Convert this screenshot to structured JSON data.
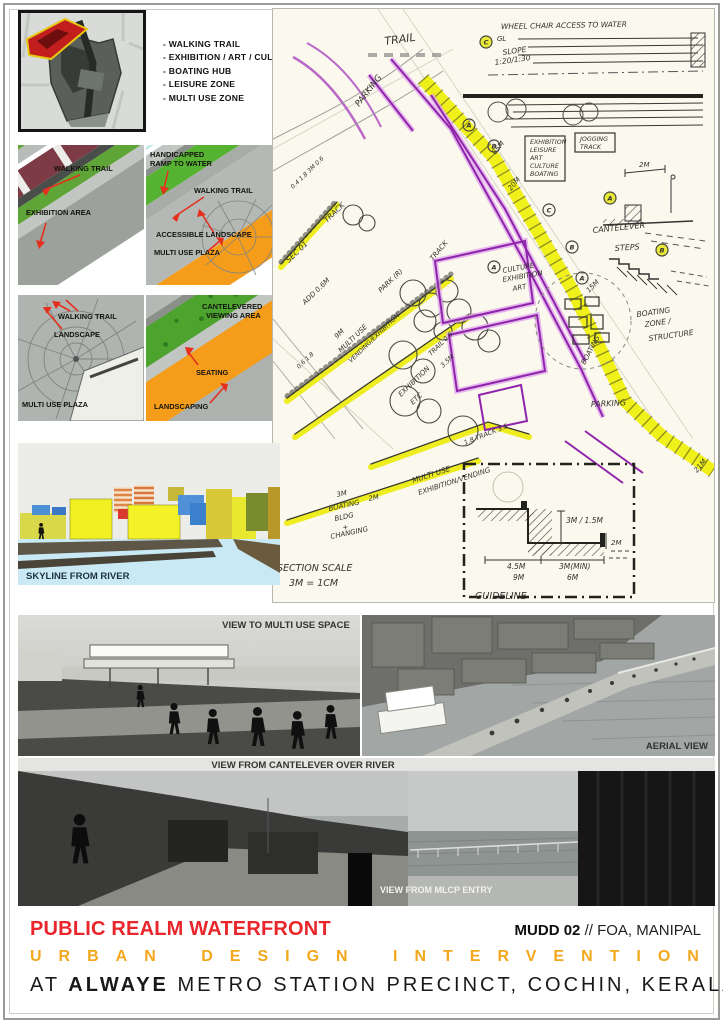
{
  "legend": {
    "items": [
      "- WALKING TRAIL",
      "- EXHIBITION / ART / CULTURE ZONE",
      "- BOATING HUB",
      "- LEISURE ZONE",
      "- MULTI USE ZONE"
    ]
  },
  "colors": {
    "accent_red": "#E8262C",
    "accent_amber": "#F2A71C",
    "highlight_yellow": "#EFEF08",
    "sketch_purple": "#8E24AA"
  },
  "sketch": {
    "labels": [
      {
        "id": "trail",
        "t": "TRAIL",
        "x": 112,
        "y": 36,
        "r": -8,
        "s": 11
      },
      {
        "id": "wheelchair-access",
        "t": "WHEEL CHAIR ACCESS TO WATER",
        "x": 228,
        "y": 20,
        "r": -1,
        "s": 7.5
      },
      {
        "id": "gl",
        "t": "GL",
        "x": 224,
        "y": 32,
        "s": 7
      },
      {
        "id": "slope",
        "t": "SLOPE",
        "x": 230,
        "y": 46,
        "r": -8,
        "s": 7.5
      },
      {
        "id": "slope-ratio",
        "t": "1:20/1:30",
        "x": 222,
        "y": 56,
        "r": -8,
        "s": 7.5
      },
      {
        "id": "parking-top",
        "t": "PARKING",
        "x": 86,
        "y": 98,
        "r": -52,
        "s": 8.5
      },
      {
        "id": "zone-box-1",
        "t": "EXHIBITION",
        "x": 257,
        "y": 135,
        "s": 6.3
      },
      {
        "id": "zone-box-2",
        "t": "LEISURE",
        "x": 257,
        "y": 143,
        "s": 6.3
      },
      {
        "id": "zone-box-3",
        "t": "ART",
        "x": 257,
        "y": 151,
        "s": 6.3
      },
      {
        "id": "zone-box-4",
        "t": "CULTURE",
        "x": 257,
        "y": 159,
        "s": 6.3
      },
      {
        "id": "zone-box-5",
        "t": "BOATING",
        "x": 257,
        "y": 167,
        "s": 6.3
      },
      {
        "id": "jogging-1",
        "t": "JOGGING",
        "x": 307,
        "y": 132,
        "s": 6.3
      },
      {
        "id": "jogging-2",
        "t": "TRACK",
        "x": 307,
        "y": 140,
        "s": 6.3
      },
      {
        "id": "dim-2m-cantelever",
        "t": "2M",
        "x": 366,
        "y": 158,
        "s": 7
      },
      {
        "id": "cantelever",
        "t": "CANTELEVER",
        "x": 320,
        "y": 224,
        "r": -6,
        "s": 8
      },
      {
        "id": "steps",
        "t": "STEPS",
        "x": 342,
        "y": 242,
        "r": -4,
        "s": 8
      },
      {
        "id": "dim-65m",
        "t": "65M",
        "x": 222,
        "y": 146,
        "r": -50,
        "s": 7
      },
      {
        "id": "dim-20m",
        "t": "20M",
        "x": 238,
        "y": 182,
        "r": -50,
        "s": 7
      },
      {
        "id": "culture-1",
        "t": "CULTURE",
        "x": 230,
        "y": 264,
        "r": -10,
        "s": 7
      },
      {
        "id": "culture-2",
        "t": "EXHIBITION",
        "x": 230,
        "y": 273,
        "r": -10,
        "s": 7
      },
      {
        "id": "culture-3",
        "t": "ART",
        "x": 240,
        "y": 282,
        "r": -10,
        "s": 7
      },
      {
        "id": "dim-15m",
        "t": "15M",
        "x": 316,
        "y": 284,
        "r": -45,
        "s": 7
      },
      {
        "id": "boating-zone-1",
        "t": "BOATING",
        "x": 364,
        "y": 308,
        "r": -8,
        "s": 7.5
      },
      {
        "id": "boating-zone-2",
        "t": "ZONE /",
        "x": 372,
        "y": 318,
        "r": -8,
        "s": 7.5
      },
      {
        "id": "boating-zone-3",
        "t": "STRUCTURE",
        "x": 376,
        "y": 332,
        "r": -8,
        "s": 7.5
      },
      {
        "id": "boating-band",
        "t": "BOATING",
        "x": 312,
        "y": 356,
        "r": -62,
        "s": 7
      },
      {
        "id": "parking-mid",
        "t": "PARKING",
        "x": 318,
        "y": 398,
        "r": -3,
        "s": 8
      },
      {
        "id": "sec-01",
        "t": "SEC 01",
        "x": 16,
        "y": 254,
        "r": -44,
        "s": 7.5
      },
      {
        "id": "track-a",
        "t": "TRACK",
        "x": 54,
        "y": 214,
        "r": -44,
        "s": 7.5
      },
      {
        "id": "dims-a",
        "t": "0.4 1.8 3M 0.6",
        "x": 20,
        "y": 180,
        "r": -44,
        "s": 6
      },
      {
        "id": "track-b",
        "t": "TRACK",
        "x": 160,
        "y": 252,
        "r": -50,
        "s": 7
      },
      {
        "id": "add-06m",
        "t": "ADD 0.6M",
        "x": 32,
        "y": 296,
        "r": -44,
        "s": 7
      },
      {
        "id": "park-r",
        "t": "PARK (R)",
        "x": 108,
        "y": 284,
        "r": -44,
        "s": 7
      },
      {
        "id": "dim-9m",
        "t": "9M",
        "x": 64,
        "y": 330,
        "r": -44,
        "s": 7
      },
      {
        "id": "multi-use-a",
        "t": "MULTI USE",
        "x": 68,
        "y": 344,
        "r": -44,
        "s": 7
      },
      {
        "id": "vending-exhibition",
        "t": "VENDING/EXHIBITION",
        "x": 78,
        "y": 354,
        "r": -44,
        "s": 6.3
      },
      {
        "id": "dims-b",
        "t": "0.6 1.8",
        "x": 26,
        "y": 360,
        "r": -44,
        "s": 6
      },
      {
        "id": "trail-06",
        "t": "TRAIL 0.6",
        "x": 158,
        "y": 347,
        "r": -44,
        "s": 6.5
      },
      {
        "id": "dim-35m",
        "t": "3.5M",
        "x": 170,
        "y": 359,
        "r": -44,
        "s": 6.5
      },
      {
        "id": "exhibition-etc-1",
        "t": "EXHIBITION",
        "x": 128,
        "y": 388,
        "r": -44,
        "s": 7
      },
      {
        "id": "exhibition-etc-2",
        "t": "ETC",
        "x": 140,
        "y": 396,
        "r": -44,
        "s": 7
      },
      {
        "id": "dim-18-track-35",
        "t": "1.8 TRACK 3.5",
        "x": 192,
        "y": 436,
        "r": -22,
        "s": 6.5
      },
      {
        "id": "multi-use-b1",
        "t": "MULTI USE",
        "x": 140,
        "y": 474,
        "r": -18,
        "s": 7.5
      },
      {
        "id": "multi-use-b2",
        "t": "EXHIBITION/VENDING",
        "x": 146,
        "y": 486,
        "r": -18,
        "s": 7
      },
      {
        "id": "dim-3m",
        "t": "3M",
        "x": 64,
        "y": 488,
        "r": -12,
        "s": 7
      },
      {
        "id": "dim-2m-b",
        "t": "2M",
        "x": 96,
        "y": 492,
        "r": -12,
        "s": 7
      },
      {
        "id": "boating-bldg-1",
        "t": "BOATING",
        "x": 56,
        "y": 502,
        "r": -12,
        "s": 7
      },
      {
        "id": "boating-bldg-2",
        "t": "BLDG",
        "x": 62,
        "y": 512,
        "r": -12,
        "s": 7
      },
      {
        "id": "boating-bldg-3",
        "t": "+",
        "x": 70,
        "y": 521,
        "r": -12,
        "s": 7
      },
      {
        "id": "boating-bldg-4",
        "t": "CHANGING",
        "x": 58,
        "y": 530,
        "r": -12,
        "s": 7
      },
      {
        "id": "section-scale-1",
        "t": "SECTION SCALE",
        "x": 4,
        "y": 562,
        "s": 9.5
      },
      {
        "id": "section-scale-2",
        "t": "3M = 1CM",
        "x": 16,
        "y": 577,
        "s": 9.5
      },
      {
        "id": "guideline",
        "t": "GUIDELINE",
        "x": 202,
        "y": 590,
        "s": 9.5
      },
      {
        "id": "dim-3m-15m",
        "t": "3M / 1.5M",
        "x": 293,
        "y": 514,
        "s": 7.5
      },
      {
        "id": "dim-2m-c",
        "t": "2M",
        "x": 338,
        "y": 536,
        "s": 7
      },
      {
        "id": "dim-45m",
        "t": "4.5M",
        "x": 234,
        "y": 560,
        "s": 7.5
      },
      {
        "id": "dim-9m-b",
        "t": "9M",
        "x": 240,
        "y": 571,
        "s": 7.5
      },
      {
        "id": "dim-3m-min",
        "t": "3M(MIN)",
        "x": 286,
        "y": 560,
        "s": 7.5
      },
      {
        "id": "dim-6m",
        "t": "6M",
        "x": 294,
        "y": 571,
        "s": 7.5
      },
      {
        "id": "dim-21m",
        "t": "21M",
        "x": 424,
        "y": 464,
        "r": -50,
        "s": 7
      }
    ],
    "markers": [
      {
        "id": "marker-c-top",
        "letter": "C",
        "x": 213,
        "y": 33,
        "filled": true
      },
      {
        "id": "marker-a-band1",
        "letter": "A",
        "x": 196,
        "y": 116,
        "filled": false
      },
      {
        "id": "marker-b-band1",
        "letter": "B",
        "x": 221,
        "y": 137,
        "filled": false
      },
      {
        "id": "marker-a-cantelever",
        "letter": "A",
        "x": 337,
        "y": 189,
        "filled": true
      },
      {
        "id": "marker-b-steps",
        "letter": "B",
        "x": 389,
        "y": 241,
        "filled": true
      },
      {
        "id": "marker-c-band2",
        "letter": "C",
        "x": 276,
        "y": 201,
        "filled": false
      },
      {
        "id": "marker-a-band2",
        "letter": "A",
        "x": 221,
        "y": 258,
        "filled": false
      },
      {
        "id": "marker-b-band2",
        "letter": "B",
        "x": 299,
        "y": 238,
        "filled": false
      },
      {
        "id": "marker-a-band3",
        "letter": "A",
        "x": 309,
        "y": 269,
        "filled": false
      }
    ]
  },
  "plans": {
    "exhibition": {
      "walking_trail": "WALKING TRAIL",
      "exhibition_area": "EXHIBITION AREA"
    },
    "ramp": {
      "line1": "HANDICAPPED",
      "line2": "RAMP TO WATER",
      "walking_trail": "WALKING TRAIL",
      "accessible_landscape": "ACCESSIBLE LANDSCAPE",
      "multi_use_plaza": "MULTI USE PLAZA"
    },
    "plaza": {
      "walking_trail": "WALKING TRAIL",
      "landscape": "LANDSCAPE",
      "multi_use_plaza": "MULTI USE PLAZA"
    },
    "cantelever": {
      "line1": "CANTELEVERED",
      "line2": "VIEWING AREA",
      "seating": "SEATING",
      "landscaping": "LANDSCAPING"
    }
  },
  "skyline": {
    "caption": "SKYLINE FROM RIVER"
  },
  "renders": {
    "multi_use": "VIEW TO MULTI USE SPACE",
    "aerial": "AERIAL VIEW",
    "cantelever": "VIEW FROM CANTELEVER OVER RIVER",
    "mlcp": "VIEW FROM MLCP ENTRY"
  },
  "footer": {
    "title": "PUBLIC REALM WATERFRONT",
    "credit_bold": "MUDD 02",
    "credit_rest": " // FOA, MANIPAL",
    "line2": "URBAN DESIGN INTERVENTION",
    "line3_prefix": "AT ",
    "line3_bold": "ALWAYE",
    "line3_rest": " METRO STATION PRECINCT, COCHIN, KERALA"
  }
}
